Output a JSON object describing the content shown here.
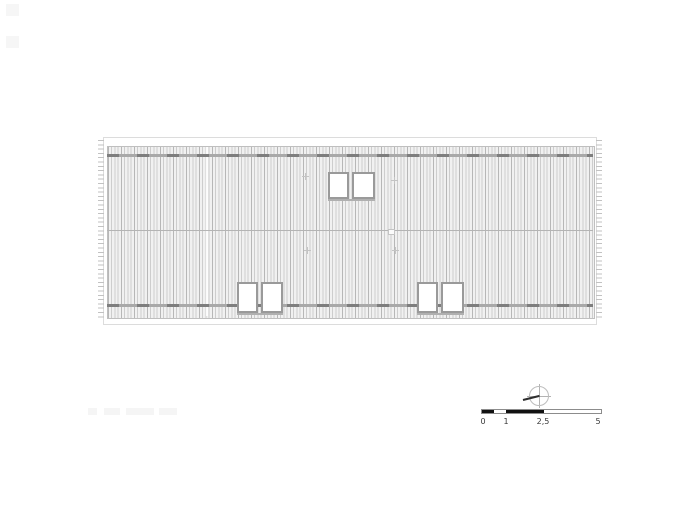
{
  "colors": {
    "hatch_line": "#cdcdcd",
    "hatch_background": "#f1f1f1",
    "hatch_accent": "#969696",
    "seam_line": "#a9a9a9",
    "seam_dash": "#7e7e7e",
    "frame_border": "#dcdcdc",
    "panel_border": "#bfbfbf",
    "ridge_line": "#b4b4b4",
    "edge_tick": "#c2c2c2",
    "skylight_border": "#9a9a9a",
    "skylight_fill": "#ffffff",
    "scale_bar_black": "#111111",
    "needle": "#2e2e2e"
  },
  "roof": {
    "skylights": [
      {
        "x": 328,
        "y": 172,
        "w": 21,
        "h": 27
      },
      {
        "x": 352,
        "y": 172,
        "w": 23,
        "h": 27
      },
      {
        "x": 237,
        "y": 282,
        "w": 21,
        "h": 31
      },
      {
        "x": 261,
        "y": 282,
        "w": 22,
        "h": 31
      },
      {
        "x": 417,
        "y": 282,
        "w": 21,
        "h": 31
      },
      {
        "x": 441,
        "y": 282,
        "w": 23,
        "h": 31
      }
    ],
    "sills": [
      {
        "x": 328,
        "y": 199,
        "w": 47
      },
      {
        "x": 237,
        "y": 313,
        "w": 46
      },
      {
        "x": 417,
        "y": 313,
        "w": 47
      }
    ],
    "drain_marks": [
      {
        "x": 302,
        "y": 173
      },
      {
        "x": 391,
        "y": 177
      },
      {
        "x": 304,
        "y": 247
      },
      {
        "x": 392,
        "y": 247
      }
    ],
    "ridge_vent": {
      "x": 388,
      "y": 229,
      "w": 7,
      "h": 6
    }
  },
  "page_marks": [
    {
      "x": 6,
      "y": 4,
      "w": 13,
      "h": 12
    },
    {
      "x": 6,
      "y": 36,
      "w": 13,
      "h": 12
    }
  ],
  "faded_title_blocks": [
    {
      "x": 88,
      "y": 408,
      "w": 9
    },
    {
      "x": 104,
      "y": 408,
      "w": 16
    },
    {
      "x": 126,
      "y": 408,
      "w": 28
    },
    {
      "x": 159,
      "y": 408,
      "w": 18
    }
  ],
  "scale_bar": {
    "labels": [
      "0",
      "1",
      "2,5",
      "5"
    ]
  }
}
